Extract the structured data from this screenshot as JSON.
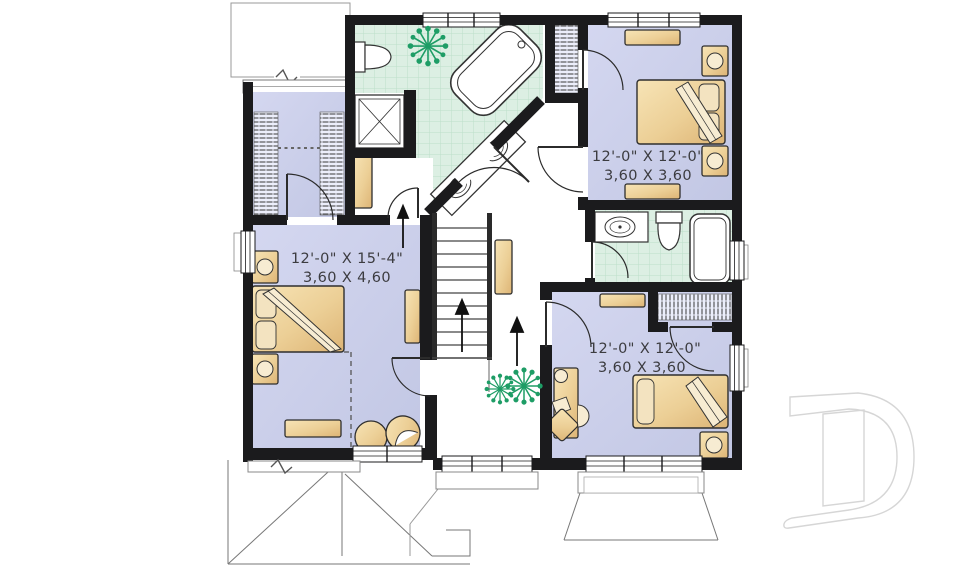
{
  "plan": {
    "title": "second-floor-plan",
    "rooms": {
      "master": {
        "name": "master-bedroom",
        "imperial": "12'-0\" X 15'-4\"",
        "metric": "3,60 X 4,60"
      },
      "bedroom2": {
        "name": "bedroom-top-right",
        "imperial": "12'-0\" X 12'-0\"",
        "metric": "3,60 X 3,60"
      },
      "bedroom3": {
        "name": "bedroom-bottom-right",
        "imperial": "12'-0\" X 12'-0\"",
        "metric": "3,60 X 3,60"
      }
    },
    "fixtures": [
      "corner-bathtub",
      "shower",
      "double-vanity-sinks",
      "toilet",
      "bathtub",
      "sink",
      "stairs-up",
      "beds",
      "nightstands",
      "dressers",
      "desk",
      "plants"
    ],
    "watermark_letter": "D",
    "colors": {
      "wall": "#1b1b1d",
      "bedroom_floor": "#c9cdea",
      "bath_tile": "#dcefe3",
      "bath_tile_grid": "#bcdfc9",
      "furniture_tan": "#eed3a0",
      "plant_green": "#1e9d66",
      "watermark_gray": "#d6d6d6"
    }
  }
}
